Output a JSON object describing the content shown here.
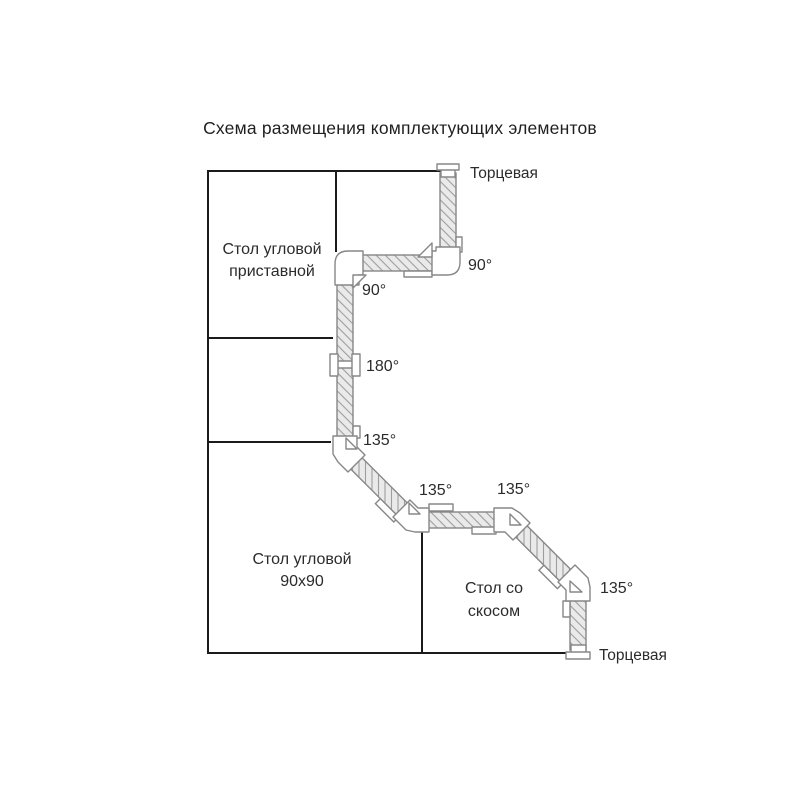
{
  "title": "Схема размещения комплектующих элементов",
  "diagram": {
    "tables": [
      {
        "id": "corner-attached-table",
        "label_line1": "Стол угловой",
        "label_line2": "приставной"
      },
      {
        "id": "corner-90x90-table",
        "label_line1": "Стол угловой",
        "label_line2": "90х90"
      },
      {
        "id": "beveled-table",
        "label_line1": "Стол со",
        "label_line2": "скосом"
      }
    ],
    "end_caps": [
      {
        "position": "top",
        "label": "Торцевая"
      },
      {
        "position": "bottom",
        "label": "Торцевая"
      }
    ],
    "angle_labels": [
      {
        "value": "90°",
        "position": "top-right-corner"
      },
      {
        "value": "90°",
        "position": "left-corner"
      },
      {
        "value": "180°",
        "position": "straight-connector"
      },
      {
        "value": "135°",
        "position": "first-bevel"
      },
      {
        "value": "135°",
        "position": "second-bevel"
      },
      {
        "value": "135°",
        "position": "third-bevel"
      },
      {
        "value": "135°",
        "position": "bottom-bevel"
      }
    ],
    "colors": {
      "outline": "#1b1b1b",
      "profile_outline": "#878787",
      "profile_fill": "#eaeaea",
      "hatch_line": "#9e9e9e",
      "text": "#2b2b2b"
    }
  }
}
